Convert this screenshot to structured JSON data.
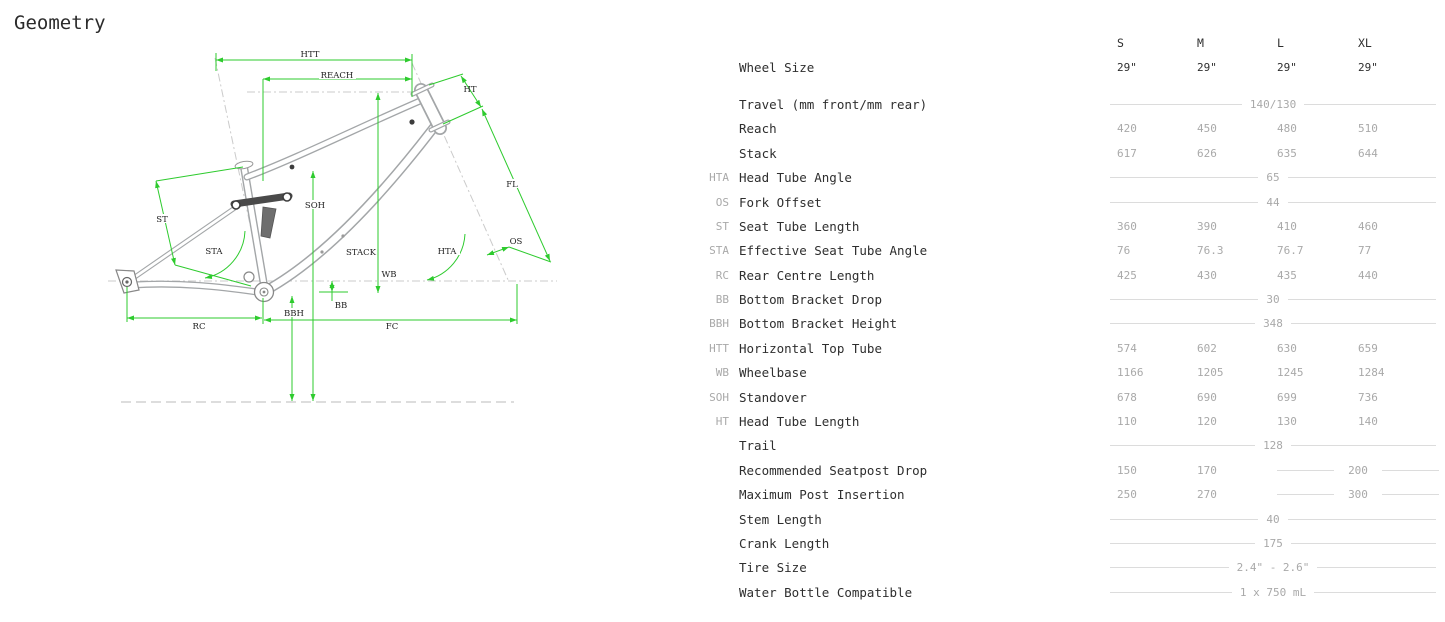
{
  "title": "Geometry",
  "colors": {
    "dimension_green": "#2ecb2e",
    "frame_gray": "#a3a6a8",
    "text_dark": "#2e2e2e",
    "text_muted": "#a9a9a9",
    "rule_gray": "#dcdcdc"
  },
  "diagram": {
    "labels": {
      "htt": "HTT",
      "reach": "REACH",
      "ht": "HT",
      "fl": "FL",
      "st": "ST",
      "soh": "SOH",
      "sta": "STA",
      "stack": "STACK",
      "hta": "HTA",
      "os": "OS",
      "wb": "WB",
      "bb": "BB",
      "bbh": "BBH",
      "rc": "RC",
      "fc": "FC"
    }
  },
  "table": {
    "size_headers": [
      "S",
      "M",
      "L",
      "XL"
    ],
    "rows": [
      {
        "abbr": "",
        "label": "Wheel Size",
        "type": "cols",
        "values": [
          "29\"",
          "29\"",
          "29\"",
          "29\""
        ]
      },
      {
        "abbr": "",
        "label": "Travel (mm front/mm rear)",
        "type": "span",
        "value": "140/130"
      },
      {
        "abbr": "",
        "label": "Reach",
        "type": "cols",
        "values": [
          "420",
          "450",
          "480",
          "510"
        ]
      },
      {
        "abbr": "",
        "label": "Stack",
        "type": "cols",
        "values": [
          "617",
          "626",
          "635",
          "644"
        ]
      },
      {
        "abbr": "HTA",
        "label": "Head Tube Angle",
        "type": "span",
        "value": "65"
      },
      {
        "abbr": "OS",
        "label": "Fork Offset",
        "type": "span",
        "value": "44"
      },
      {
        "abbr": "ST",
        "label": "Seat Tube Length",
        "type": "cols",
        "values": [
          "360",
          "390",
          "410",
          "460"
        ]
      },
      {
        "abbr": "STA",
        "label": "Effective Seat Tube Angle",
        "type": "cols",
        "values": [
          "76",
          "76.3",
          "76.7",
          "77"
        ]
      },
      {
        "abbr": "RC",
        "label": "Rear Centre Length",
        "type": "cols",
        "values": [
          "425",
          "430",
          "435",
          "440"
        ]
      },
      {
        "abbr": "BB",
        "label": "Bottom Bracket Drop",
        "type": "span",
        "value": "30"
      },
      {
        "abbr": "BBH",
        "label": "Bottom Bracket Height",
        "type": "span",
        "value": "348"
      },
      {
        "abbr": "HTT",
        "label": "Horizontal Top Tube",
        "type": "cols",
        "values": [
          "574",
          "602",
          "630",
          "659"
        ]
      },
      {
        "abbr": "WB",
        "label": "Wheelbase",
        "type": "cols",
        "values": [
          "1166",
          "1205",
          "1245",
          "1284"
        ]
      },
      {
        "abbr": "SOH",
        "label": "Standover",
        "type": "cols",
        "values": [
          "678",
          "690",
          "699",
          "736"
        ]
      },
      {
        "abbr": "HT",
        "label": "Head Tube Length",
        "type": "cols",
        "values": [
          "110",
          "120",
          "130",
          "140"
        ]
      },
      {
        "abbr": "",
        "label": "Trail",
        "type": "span",
        "value": "128"
      },
      {
        "abbr": "",
        "label": "Recommended Seatpost Drop",
        "type": "mixed",
        "values": [
          "150",
          "170"
        ],
        "span_value": "200"
      },
      {
        "abbr": "",
        "label": "Maximum Post Insertion",
        "type": "mixed",
        "values": [
          "250",
          "270"
        ],
        "span_value": "300"
      },
      {
        "abbr": "",
        "label": "Stem Length",
        "type": "span",
        "value": "40"
      },
      {
        "abbr": "",
        "label": "Crank Length",
        "type": "span",
        "value": "175"
      },
      {
        "abbr": "",
        "label": "Tire Size",
        "type": "span",
        "value": "2.4\" - 2.6\""
      },
      {
        "abbr": "",
        "label": "Water Bottle Compatible",
        "type": "span",
        "value": "1 x 750 mL"
      }
    ]
  }
}
